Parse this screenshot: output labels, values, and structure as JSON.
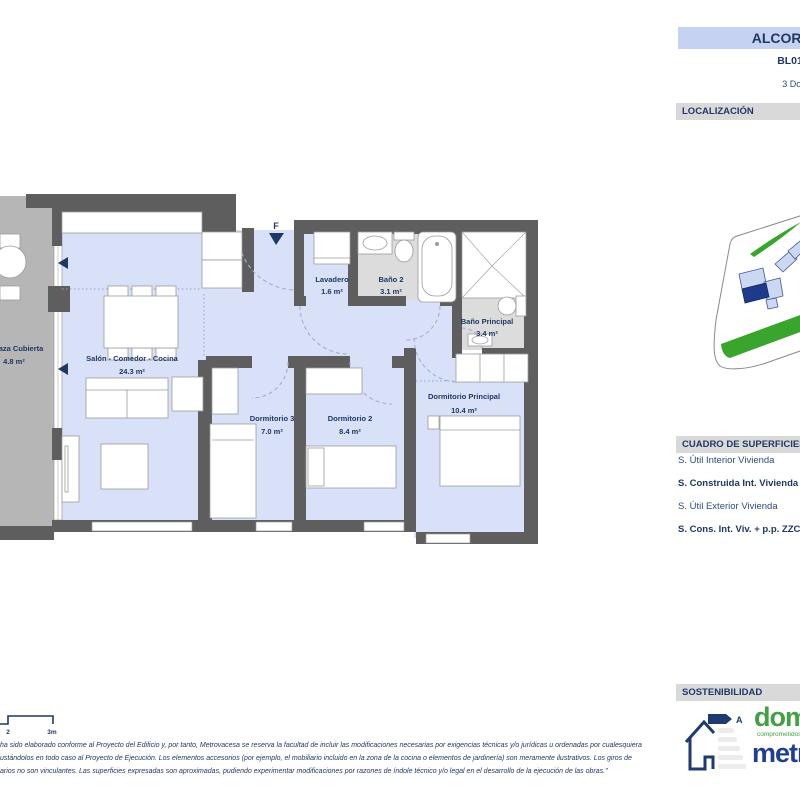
{
  "header": {
    "title": "ALCORA HOMES",
    "plan_code": "BL01_P2_2A",
    "dwelling_type": "3 Dormitorios"
  },
  "sections": {
    "localizacion": "LOCALIZACIÓN",
    "superficies": "CUADRO DE SUPERFICIES",
    "sostenibilidad": "SOSTENIBILIDAD"
  },
  "floorplan": {
    "entrance_label": "F",
    "rooms": [
      {
        "name": "Terraza Cubierta",
        "area": "4.8 m²"
      },
      {
        "name": "Salón - Comedor - Cocina",
        "area": "24.3 m²"
      },
      {
        "name": "Lavadero",
        "area": "1.6 m²"
      },
      {
        "name": "Baño 2",
        "area": "3.1 m²"
      },
      {
        "name": "Baño Principal",
        "area": "3.4 m²"
      },
      {
        "name": "Dormitorio 3",
        "area": "7.0 m²"
      },
      {
        "name": "Dormitorio 2",
        "area": "8.4 m²"
      },
      {
        "name": "Dormitorio Principal",
        "area": "10.4 m²"
      }
    ]
  },
  "superficies_rows": [
    {
      "label": "S. Útil Interior Vivienda"
    },
    {
      "label": "S. Construida Int. Vivienda"
    },
    {
      "label": "S. Útil Exterior Vivienda"
    },
    {
      "label": "S. Cons. Int. Viv. + p.p. ZZCC"
    }
  ],
  "scale_bar": {
    "tick_2": "2",
    "tick_3": "3m"
  },
  "sustainability": {
    "energy_rating": "A",
    "brand_domum": "domum",
    "brand_tagline": "comprometidos",
    "brand_metrovacesa": "metrovacesa"
  },
  "disclaimer": {
    "line1": "ha sido elaborado conforme al Proyecto del Edificio y, por tanto, Metrovacesa se reserva la facultad de incluir las modificaciones necesarias por exigencias técnicas y/o jurídicas u ordenadas por cualesquiera",
    "line2": "ustándolos en todo caso al Proyecto de Ejecución. Los elementos accesorios (por ejemplo, el mobiliario incluido en la zona de la cocina o elementos de jardinería) son meramente ilustrativos. Los giros de",
    "line3": "arios no son vinculantes. Las superficies expresadas son aproximadas, pudiendo experimentar modificaciones por razones de índole técnico y/o legal en el desarrollo de la ejecución de las obras.\""
  },
  "colors": {
    "navy": "#1f3864",
    "floor_blue": "#d9e1f8",
    "wall_gray": "#5e5e5e",
    "terrace_gray": "#b6b6b6",
    "bath_gray": "#dcdcdc",
    "bar_gray": "#d9d9d9",
    "header_blue": "#c6d2f1",
    "map_green": "#3aa52d",
    "map_building": "#ccd7f2",
    "map_highlight": "#1e3a8c",
    "brand_green": "#43a047",
    "brand_blue": "#1e3f94"
  }
}
